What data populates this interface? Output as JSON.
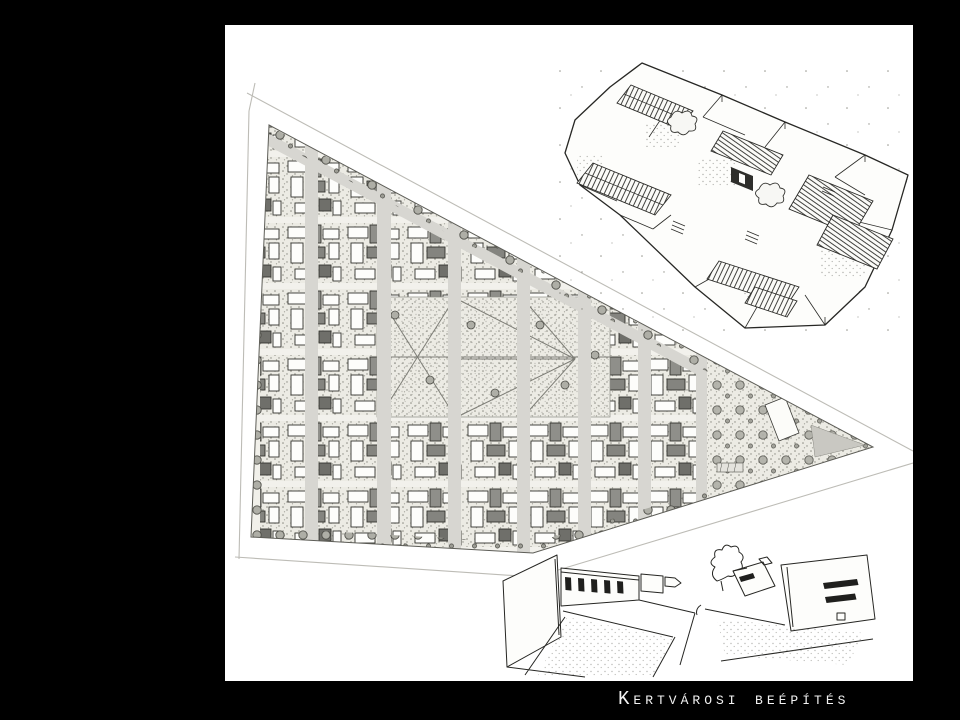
{
  "slide": {
    "title": "Kertvárosi beépítés",
    "colors": {
      "background": "#000000",
      "canvas": "#ffffff",
      "title_text": "#f2f2f2",
      "drawing_ink": "#262623",
      "street_gray": "#d7d6d1",
      "garden_tint": "#ecebe4",
      "house_shade": "#8a8a85",
      "pavement_gray": "#c9c8c2"
    }
  }
}
